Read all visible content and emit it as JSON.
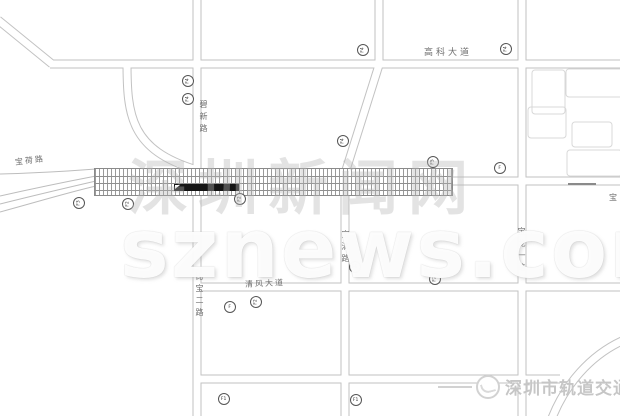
{
  "map": {
    "road_labels": [
      {
        "text": "宝荷路",
        "x": 15,
        "y": 157,
        "vertical": false,
        "size": 8,
        "spacing": 2,
        "rotate": -7
      },
      {
        "text": "碧新路",
        "x": 199,
        "y": 100,
        "vertical": true,
        "size": 8
      },
      {
        "text": "高科大道",
        "x": 424,
        "y": 49,
        "vertical": false,
        "size": 9,
        "spacing": 3,
        "rotate": 0
      },
      {
        "text": "宝清路",
        "x": 341,
        "y": 230,
        "vertical": true,
        "size": 8
      },
      {
        "text": "宝龙一路",
        "x": 517,
        "y": 227,
        "vertical": true,
        "size": 8
      },
      {
        "text": "比宝二路",
        "x": 195,
        "y": 272,
        "vertical": true,
        "size": 8
      },
      {
        "text": "清风大道",
        "x": 245,
        "y": 280,
        "vertical": false,
        "size": 8,
        "spacing": 2,
        "rotate": -3
      },
      {
        "text": "宝",
        "x": 609,
        "y": 194,
        "vertical": false,
        "size": 8
      }
    ],
    "markers": [
      {
        "label": "F3",
        "x": 79,
        "y": 203,
        "rotated": true
      },
      {
        "label": "F2",
        "x": 128,
        "y": 204,
        "rotated": true
      },
      {
        "label": "F2",
        "x": 240,
        "y": 199,
        "rotated": true
      },
      {
        "label": "F4",
        "x": 188,
        "y": 81,
        "rotated": true
      },
      {
        "label": "F4",
        "x": 188,
        "y": 99,
        "rotated": true
      },
      {
        "label": "F4",
        "x": 363,
        "y": 50,
        "rotated": true
      },
      {
        "label": "F4",
        "x": 506,
        "y": 49,
        "rotated": true
      },
      {
        "label": "F4",
        "x": 343,
        "y": 141,
        "rotated": true
      },
      {
        "label": "F5",
        "x": 433,
        "y": 162,
        "rotated": true
      },
      {
        "label": "F",
        "x": 500,
        "y": 168,
        "rotated": false
      },
      {
        "label": "F6",
        "x": 355,
        "y": 267,
        "rotated": false
      },
      {
        "label": "F2",
        "x": 435,
        "y": 279,
        "rotated": true
      },
      {
        "label": "F",
        "x": 230,
        "y": 307,
        "rotated": false
      },
      {
        "label": "F2",
        "x": 256,
        "y": 302,
        "rotated": true
      },
      {
        "label": "F1",
        "x": 224,
        "y": 399,
        "rotated": false
      },
      {
        "label": "F1",
        "x": 356,
        "y": 400,
        "rotated": false
      }
    ]
  },
  "watermark": {
    "line1": "深圳新闻网",
    "line2": "sznews.com"
  },
  "logo": {
    "text": "深圳市轨道交通"
  },
  "colors": {
    "road_line": "#c2c2c2",
    "band_line": "#8f8f8f",
    "station_fill": "#151515",
    "marker_ring": "#555555",
    "watermark_gray": "#b6b6b6",
    "logo_gray": "#c6c6c6"
  }
}
